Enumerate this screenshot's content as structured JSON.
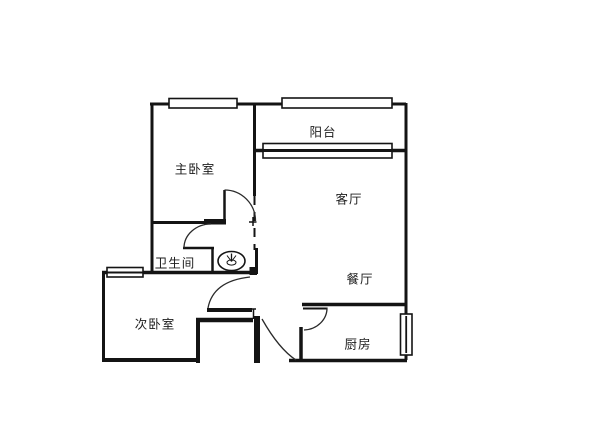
{
  "floorplan": {
    "background_color": "#ffffff",
    "wall_color": "#141414",
    "rooms": {
      "balcony": "阳台",
      "master_bedroom": "主卧室",
      "living_room": "客厅",
      "bathroom": "卫生间",
      "dining_room": "餐厅",
      "second_bedroom": "次卧室",
      "kitchen": "厨房"
    },
    "fixtures": {
      "washbasin": "washbasin"
    }
  }
}
